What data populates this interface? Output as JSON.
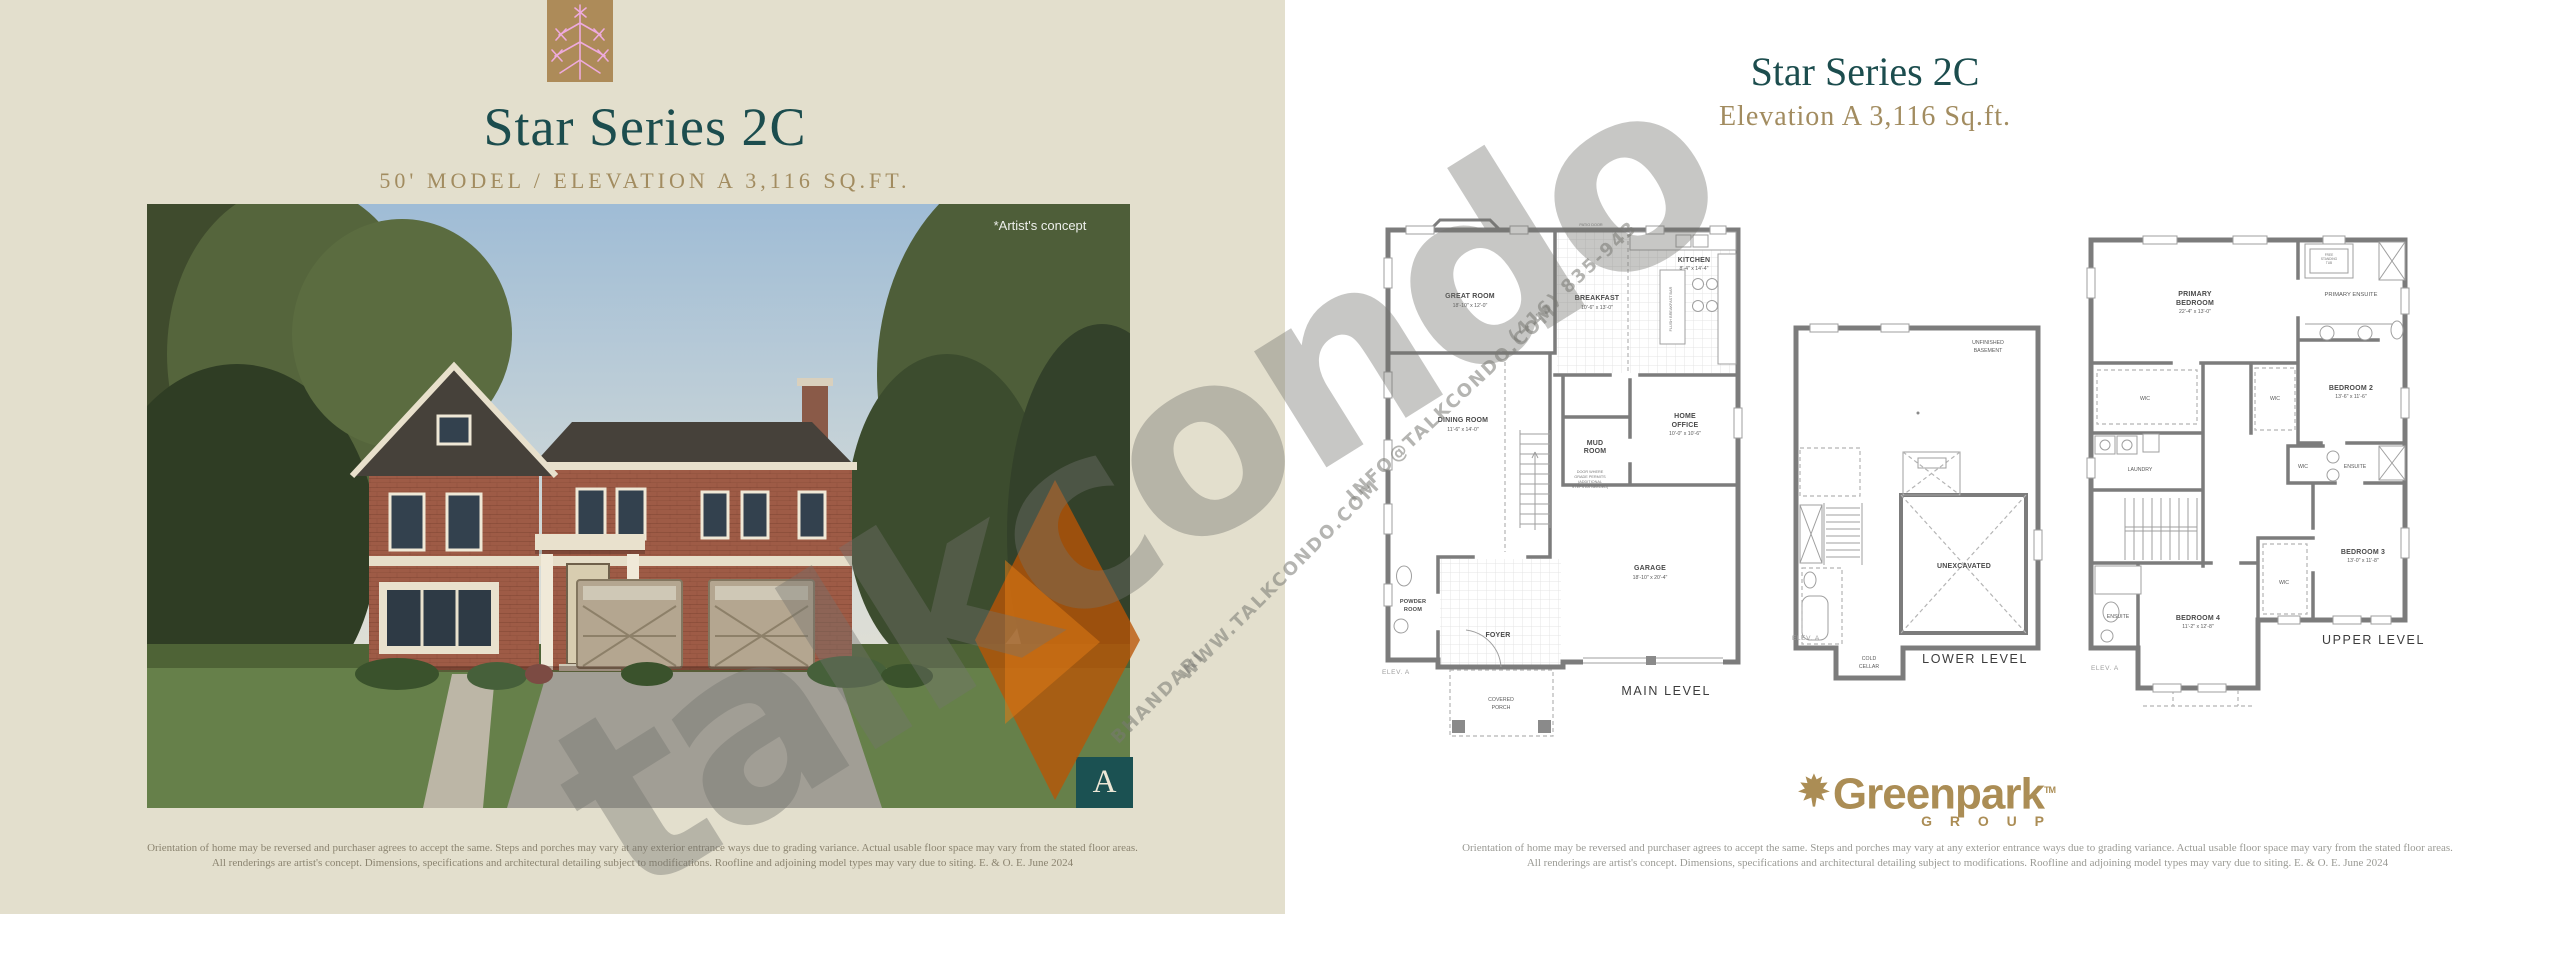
{
  "left_page": {
    "title": "Star Series 2C",
    "subtitle": "50' MODEL  /  ELEVATION A  3,116 SQ.FT.",
    "artists_concept": "*Artist's concept",
    "elevation_badge": "A",
    "disclaimer": {
      "line1": "Orientation of home may be reversed and purchaser agrees to accept the same. Steps and porches may vary at any exterior entrance ways due to grading variance. Actual usable floor space may vary from the stated floor areas.",
      "line2": "All renderings are artist's concept. Dimensions, specifications and architectural detailing subject to modifications. Roofline and adjoining model types may vary due to siting. E. & O. E. June 2024"
    }
  },
  "right_page": {
    "title": "Star Series 2C",
    "subtitle": "Elevation A   3,116 Sq.ft.",
    "brand": {
      "name": "Greenpark",
      "tm": "TM",
      "sub": "G R O U P"
    },
    "disclaimer": {
      "line1": "Orientation of home may be reversed and purchaser agrees to accept the same. Steps and porches may vary at any exterior entrance ways due to grading variance. Actual usable floor space may vary from the stated floor areas.",
      "line2": "All renderings are artist's concept. Dimensions, specifications and architectural detailing subject to modifications. Roofline and adjoining model types may vary due to siting. E. & O. E. June 2024"
    },
    "plans": {
      "main": {
        "caption": "MAIN LEVEL",
        "elev": "ELEV. A",
        "rooms": {
          "great_room": {
            "name": "GREAT ROOM",
            "dims": "18'-10\" x 12'-0\""
          },
          "breakfast": {
            "name": "BREAKFAST",
            "dims": "10'-6\" x 13'-0\""
          },
          "kitchen": {
            "name": "KITCHEN",
            "dims": "8'-4\" x 14'-4\""
          },
          "dining_room": {
            "name": "DINING ROOM",
            "dims": "11'-6\" x 14'-0\""
          },
          "home_office": {
            "name_1": "HOME",
            "name_2": "OFFICE",
            "dims": "10'-0\" x 10'-6\""
          },
          "garage": {
            "name": "GARAGE",
            "dims": "18'-10\" x 20'-4\""
          },
          "mud_1": "MUD",
          "mud_2": "ROOM",
          "powder_1": "POWDER",
          "powder_2": "ROOM",
          "foyer": "FOYER",
          "porch_1": "COVERED",
          "porch_2": "PORCH",
          "patio_door": "PATIO DOOR",
          "island": "FLUSH BREAKFAST BAR",
          "note_1": "DOOR WHERE",
          "note_2": "GRADE PERMITS",
          "note_3": "(ADDITIONAL",
          "note_4": "STEPS AS NEEDED)"
        }
      },
      "lower": {
        "caption": "LOWER LEVEL",
        "elev": "ELEV. A",
        "rooms": {
          "unfinished_1": "UNFINISHED",
          "unfinished_2": "BASEMENT",
          "unexcavated": "UNEXCAVATED",
          "cold_1": "COLD",
          "cold_2": "CELLAR"
        }
      },
      "upper": {
        "caption": "UPPER LEVEL",
        "elev": "ELEV. A",
        "rooms": {
          "primary_1": "PRIMARY",
          "primary_2": "BEDROOM",
          "primary_dims": "22'-4\" x 13'-0\"",
          "primary_ensuite": "PRIMARY ENSUITE",
          "tub_1": "FREE",
          "tub_2": "STANDING",
          "tub_3": "TUB",
          "bedroom2": {
            "name": "BEDROOM 2",
            "dims": "13'-6\" x 11'-6\""
          },
          "bedroom3": {
            "name": "BEDROOM 3",
            "dims": "13'-0\" x 11'-8\""
          },
          "bedroom4": {
            "name": "BEDROOM 4",
            "dims": "11'-2\" x 12'-8\""
          },
          "laundry": "LAUNDRY",
          "wic": "WIC",
          "ensuite": "ENSUITE"
        }
      }
    }
  },
  "watermark": {
    "big": "talkcondo",
    "site": "WWW.TALKCONDO.COM",
    "email": "INFO@TALKCONDO.COM",
    "phone": "(416) 835-943",
    "name": "BHANDARI"
  },
  "colors": {
    "beige": "#e3dfcd",
    "teal": "#1c4d4e",
    "gold": "#a28c60",
    "brand_gold": "#ab8d55",
    "wall_gray": "#7c7c7c",
    "orange": "#c05c04"
  }
}
